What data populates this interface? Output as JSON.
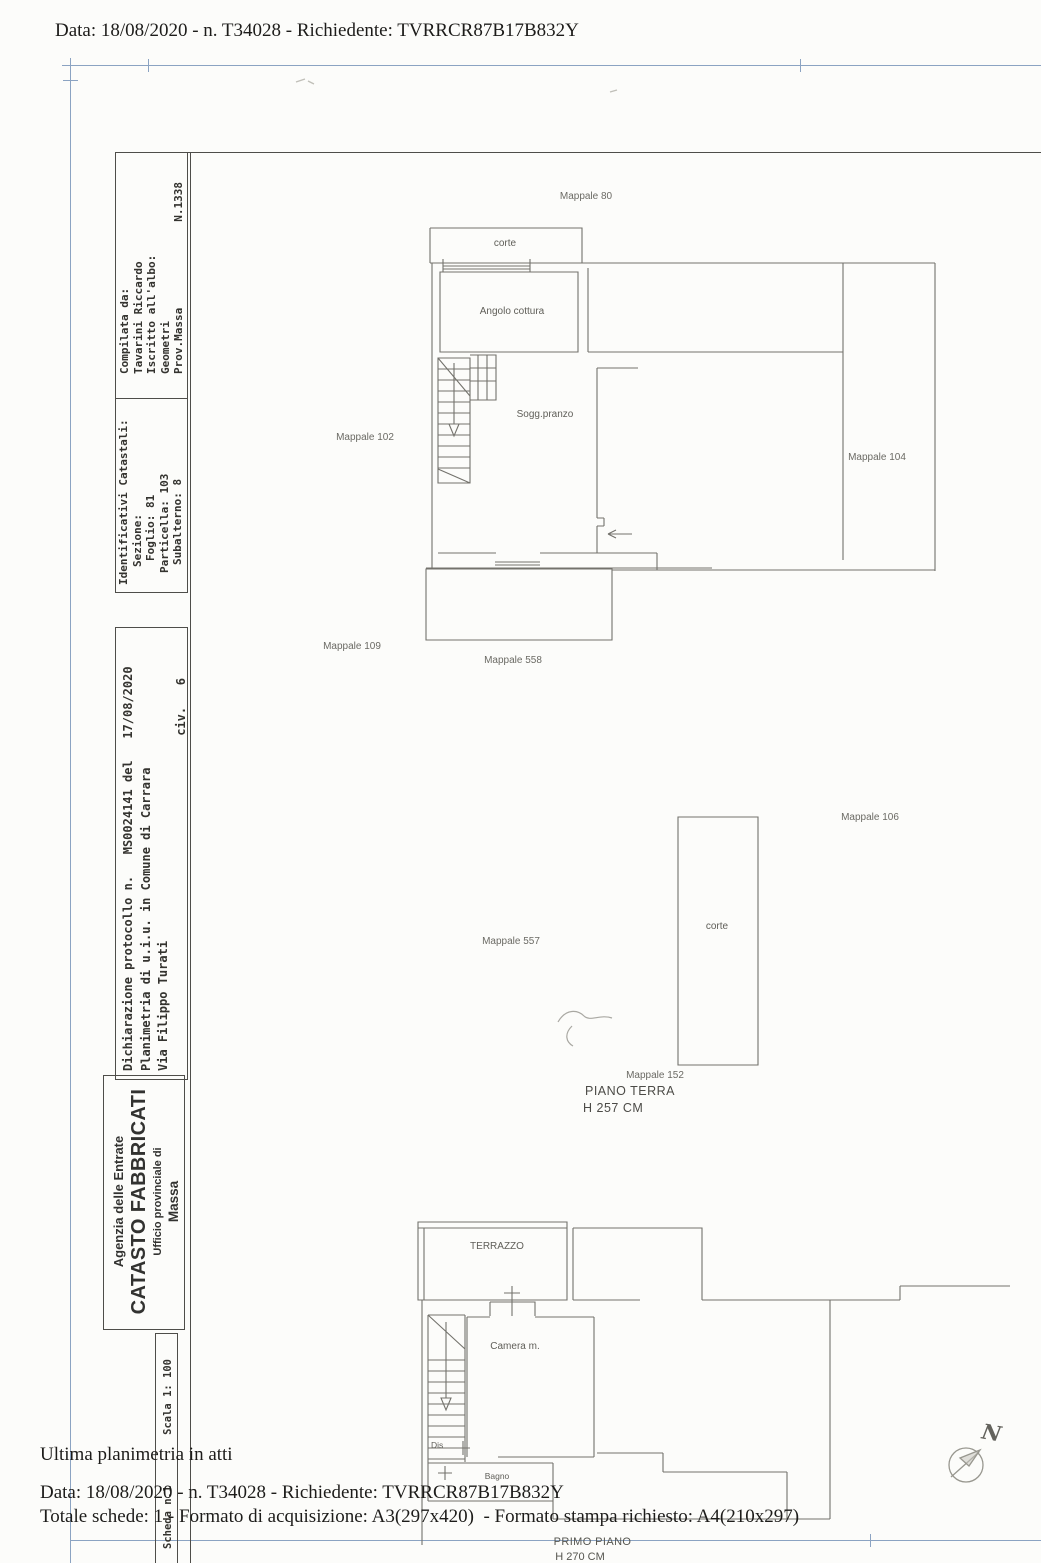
{
  "header": {
    "top_line": "Data: 18/08/2020 - n. T34028 - Richiedente: TVRRCR87B17B832Y"
  },
  "sidebar": {
    "compilata": {
      "line1": "Compilata da:",
      "line2": "Tavarini Riccardo",
      "line3": "Iscritto all'albo:",
      "line4": "Geometri",
      "prov": "Prov.Massa",
      "numero": "N.1338"
    },
    "identificativi": {
      "title": "Identificativi Catastali:",
      "sezione": "Sezione:",
      "foglio": "Foglio: 81",
      "particella": "Particella: 103",
      "subalterno": "Subalterno: 8"
    },
    "dichiarazione": {
      "line1": "Dichiarazione protocollo n.   MS0024141 del   17/08/2020",
      "line2": "Planimetria di u.i.u. in Comune di Carrara",
      "line3": "Via Filippo Turati",
      "civico": "civ.   6"
    },
    "agenzia": {
      "ente": "Agenzia delle Entrate",
      "titolo": "CATASTO FABBRICATI",
      "ufficio": "Ufficio provinciale di",
      "provincia": "Massa"
    },
    "scala": "Scala 1: 100",
    "scheda": "Scheda n.1"
  },
  "piano_terra": {
    "mappale_80": "Mappale 80",
    "corte_top": "corte",
    "angolo_cottura": "Angolo cottura",
    "mappale_102": "Mappale 102",
    "sogg_pranzo": "Sogg.pranzo",
    "mappale_104": "Mappale 104",
    "corte_bottom": "corte",
    "mappale_109": "Mappale 109",
    "mappale_558": "Mappale 558",
    "mappale_106": "Mappale 106",
    "mappale_557": "Mappale 557",
    "corte_mid": "corte",
    "mappale_152": "Mappale 152",
    "floor_label": "PIANO TERRA",
    "height_label": "H 257 CM"
  },
  "piano_primo": {
    "terrazzo": "TERRAZZO",
    "camera": "Camera m.",
    "dis": "Dis",
    "bagno": "Bagno",
    "floor_label": "PRIMO PIANO",
    "height_label": "H 270 CM"
  },
  "compass": {
    "north": "N"
  },
  "footer": {
    "line1": "Ultima planimetria in atti",
    "line2": "Data: 18/08/2020 - n. T34028 - Richiedente: TVRRCR87B17B832Y",
    "line3": "Totale schede: 1 - Formato di acquisizione: A3(297x420)  - Formato stampa richiesto: A4(210x297)"
  },
  "colors": {
    "frame_blue": "#8ba3c2",
    "frame_dark": "#4e4d49",
    "plan_line": "#73726c",
    "paper": "#fcfcfa"
  }
}
